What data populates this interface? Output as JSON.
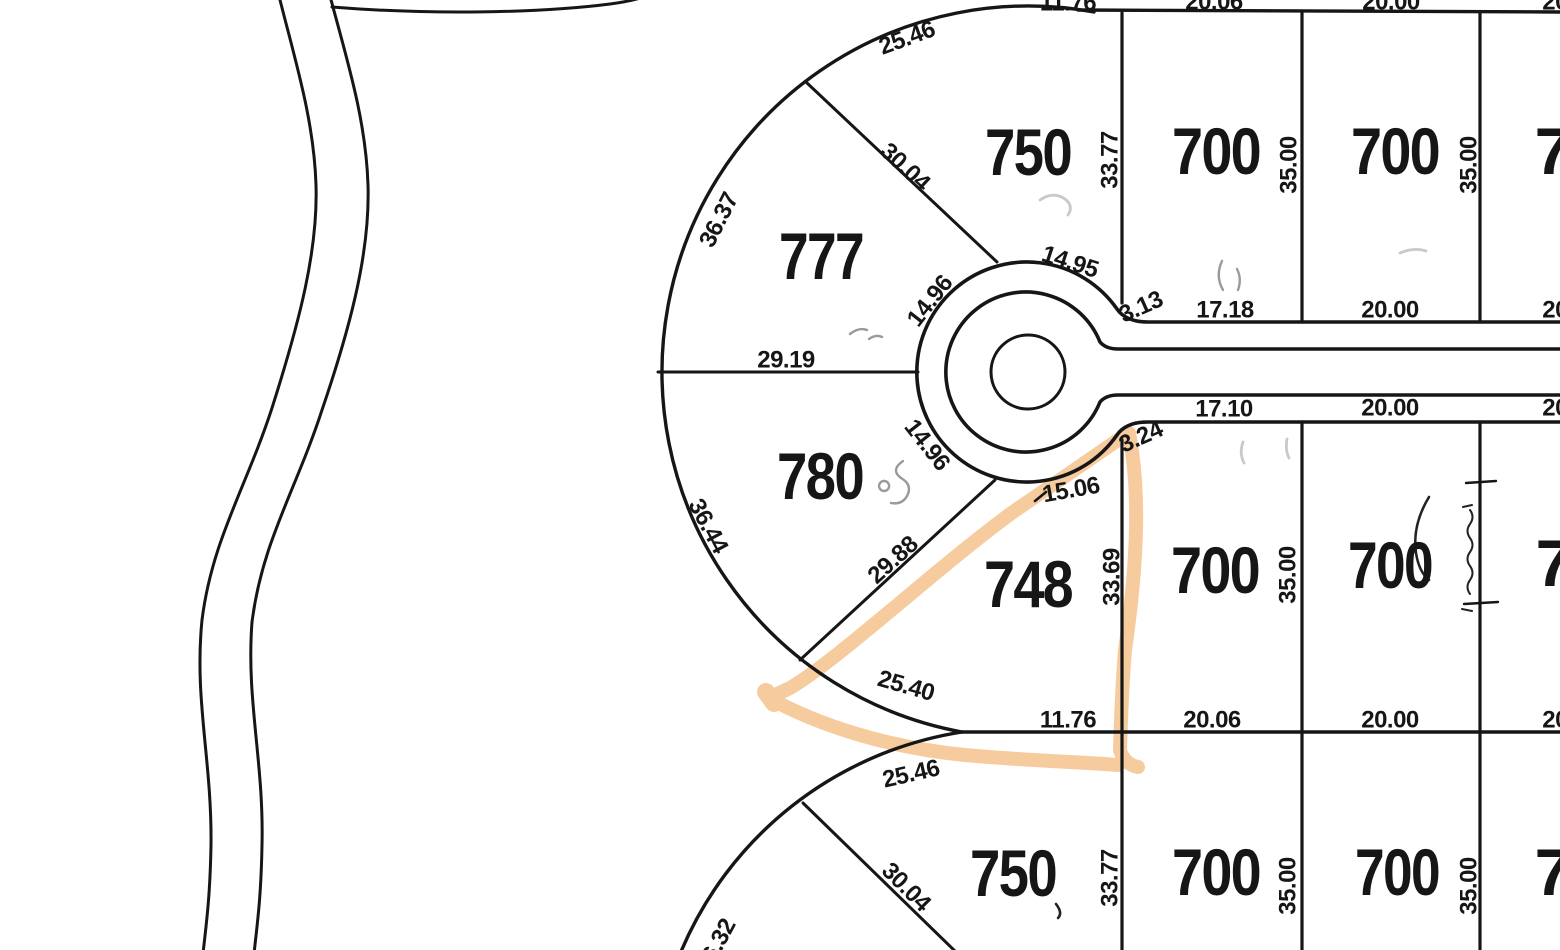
{
  "colors": {
    "ink": "#161616",
    "highlight": "#f5c38e",
    "scribble_gray": "#9a9a9a",
    "scribble_faint": "#c9c9c9",
    "scribble_dark": "#222222"
  },
  "lots": {
    "top_fan_upper": "777",
    "top_fan_lower": "780",
    "top_center": "750",
    "top_right_1": "700",
    "top_right_2": "700",
    "top_right_3_partial": "7",
    "mid_center": "748",
    "mid_right_1": "700",
    "mid_right_2": "700",
    "mid_right_3_partial": "7",
    "bottom_center": "750",
    "bottom_right_1": "700",
    "bottom_right_2": "700",
    "bottom_right_3_partial": "7"
  },
  "dims": {
    "arc_2546_top": "25.46",
    "d_3004_top": "30.04",
    "d_3637": "36.37",
    "d_3377_top": "33.77",
    "d_3500_t1": "35.00",
    "d_3500_t2": "35.00",
    "edge_1176_top": "11.76",
    "edge_2006_top": "20.06",
    "edge_2000_top": "20.00",
    "edge_2000_top_clip": "20.00",
    "d_1495": "14.95",
    "d_1496_upper": "14.96",
    "d_313": "3.13",
    "front_1718": "17.18",
    "front_2000_top": "20.00",
    "front_2000_top_clip": "20.00",
    "d_2919": "29.19",
    "d_3644": "36.44",
    "d_1496_lower": "14.96",
    "d_1506": "15.06",
    "d_324": "3.24",
    "front_1710": "17.10",
    "front_2000_mid": "20.00",
    "front_2000_mid_clip": "20.00",
    "d_3369": "33.69",
    "d_3500_m1": "35.00",
    "d_2988": "29.88",
    "d_2540": "25.40",
    "edge_1176_bot": "11.76",
    "edge_2006_bot": "20.06",
    "edge_2000_bot": "20.00",
    "edge_2000_bot_clip": "20.00",
    "arc_2546_bot": "25.46",
    "d_3004_bot": "30.04",
    "d_3632_partial": "36.32",
    "d_3377_bot": "33.77",
    "d_3500_b1": "35.00",
    "d_3500_b2": "35.00"
  }
}
